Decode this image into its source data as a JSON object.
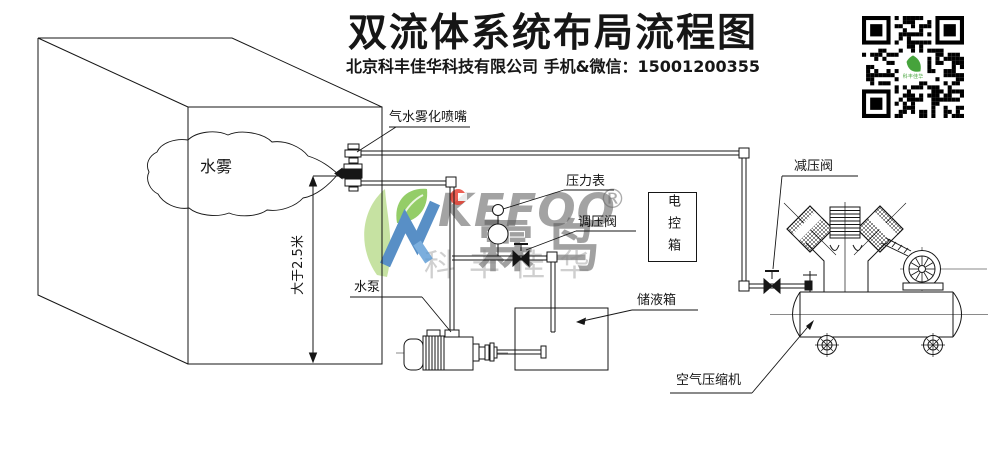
{
  "header": {
    "title": "双流体系统布局流程图",
    "subtitle": "北京科丰佳华科技有限公司 手机&微信：15001200355"
  },
  "diagram": {
    "labels": {
      "nozzle": "气水雾化喷嘴",
      "water_mist": "水雾",
      "dimension": "大于2.5米",
      "pressure_gauge": "压力表",
      "regulating_valve": "调压阀",
      "control_box": "电控箱",
      "water_pump": "水泵",
      "liquid_tank": "储液箱",
      "reducing_valve": "减压阀",
      "air_compressor": "空气压缩机"
    }
  },
  "watermark": {
    "brand_latin": "KEFOO",
    "brand_cn": "霖鸟",
    "company_short": "科丰佳华",
    "registered": "®",
    "colors": {
      "leaf_light_green": "#b9dc8c",
      "leaf_green": "#7ac143",
      "logo_blue": "#2f74b8",
      "logo_red": "#e8392b",
      "gray": "#6a6a6a"
    }
  },
  "qr": {
    "name": "wechat-qr-code",
    "center_logo_color": "#46a33c"
  }
}
